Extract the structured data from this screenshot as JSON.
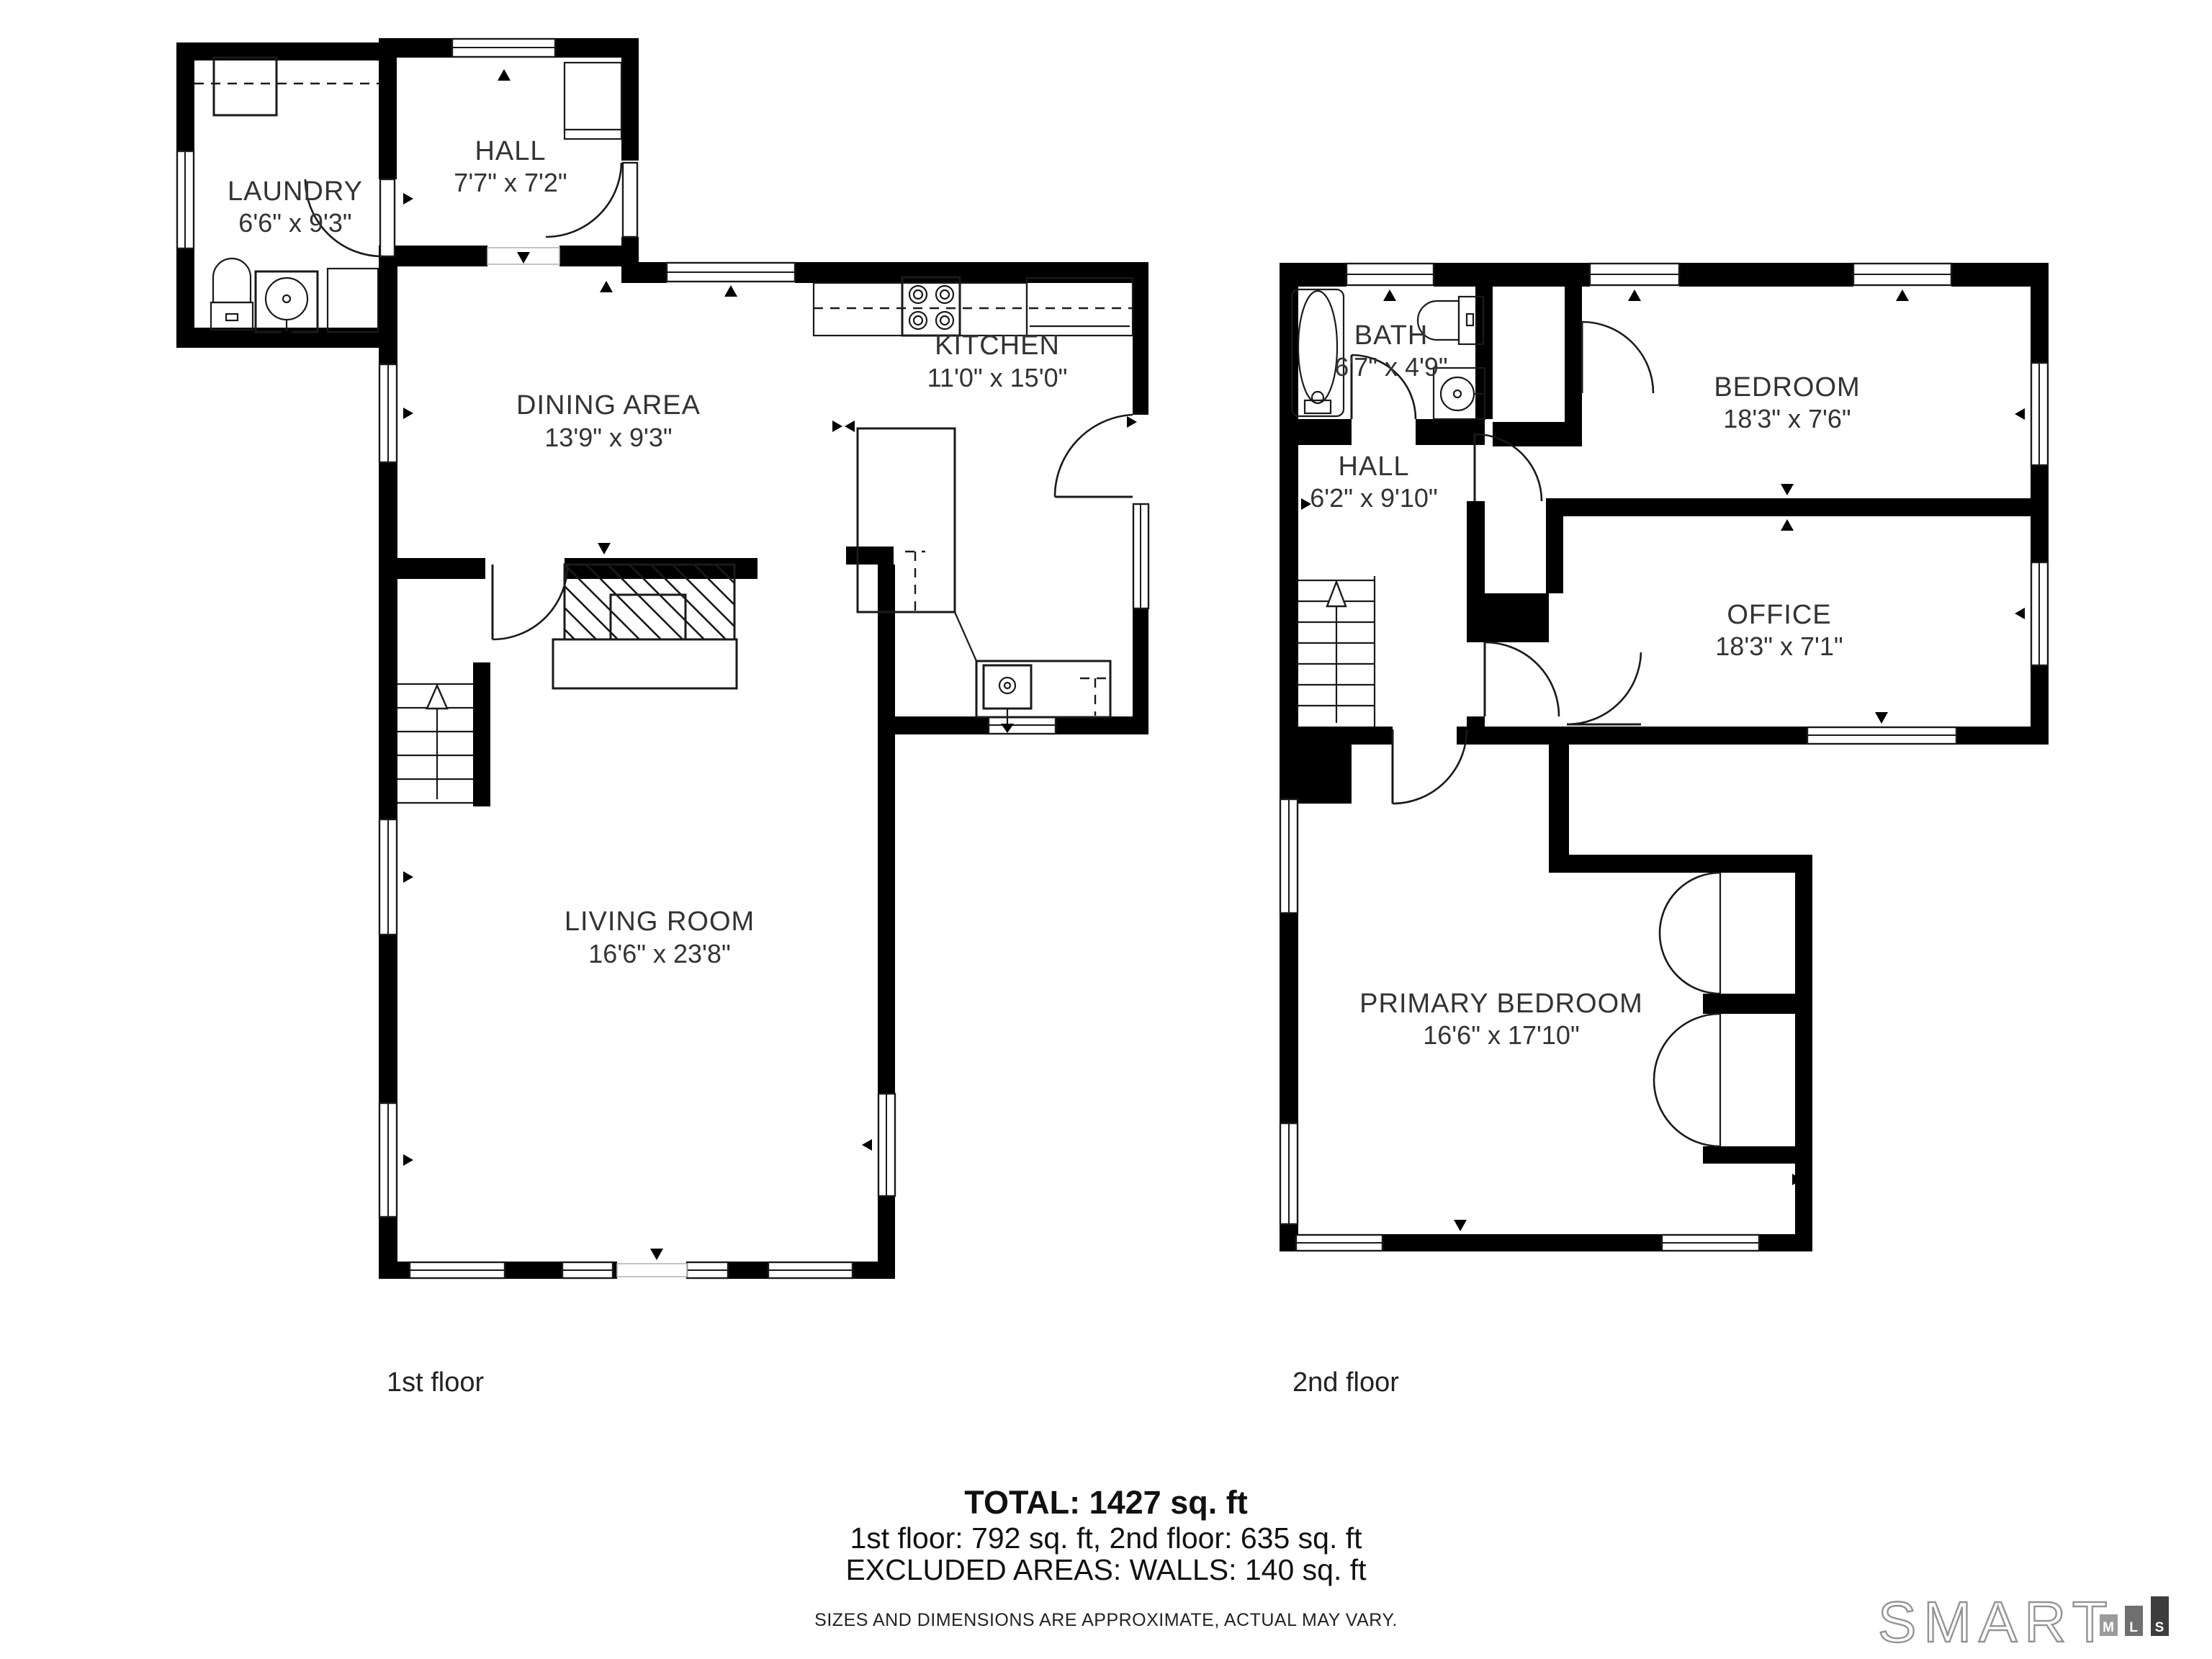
{
  "floors": [
    {
      "name": "1st floor",
      "rooms": [
        {
          "id": "laundry",
          "label": "LAUNDRY",
          "dims": "6'6\" x 9'3\""
        },
        {
          "id": "hall1",
          "label": "HALL",
          "dims": "7'7\" x 7'2\""
        },
        {
          "id": "dining",
          "label": "DINING AREA",
          "dims": "13'9\" x 9'3\""
        },
        {
          "id": "kitchen",
          "label": "KITCHEN",
          "dims": "11'0\" x 15'0\""
        },
        {
          "id": "living",
          "label": "LIVING ROOM",
          "dims": "16'6\" x 23'8\""
        }
      ]
    },
    {
      "name": "2nd floor",
      "rooms": [
        {
          "id": "bath",
          "label": "BATH",
          "dims": "6'7\" x 4'9\""
        },
        {
          "id": "hall2",
          "label": "HALL",
          "dims": "6'2\" x 9'10\""
        },
        {
          "id": "bedroom",
          "label": "BEDROOM",
          "dims": "18'3\" x 7'6\""
        },
        {
          "id": "office",
          "label": "OFFICE",
          "dims": "18'3\" x 7'1\""
        },
        {
          "id": "primary",
          "label": "PRIMARY BEDROOM",
          "dims": "16'6\" x 17'10\""
        }
      ]
    }
  ],
  "summary": {
    "total": "TOTAL: 1427 sq. ft",
    "floors_line": "1st floor: 792 sq. ft, 2nd floor: 635 sq. ft",
    "excluded": "EXCLUDED AREAS: WALLS: 140 sq. ft",
    "disclaimer": "SIZES AND DIMENSIONS ARE APPROXIMATE, ACTUAL MAY VARY."
  },
  "logo": {
    "brand": "SMART",
    "bars": [
      "M",
      "L",
      "S"
    ]
  },
  "colors": {
    "wall": "#000000",
    "text": "#333333",
    "bar_m": "#9b9b9b",
    "bar_l": "#6f6f6f",
    "bar_s": "#3d3d3d"
  }
}
